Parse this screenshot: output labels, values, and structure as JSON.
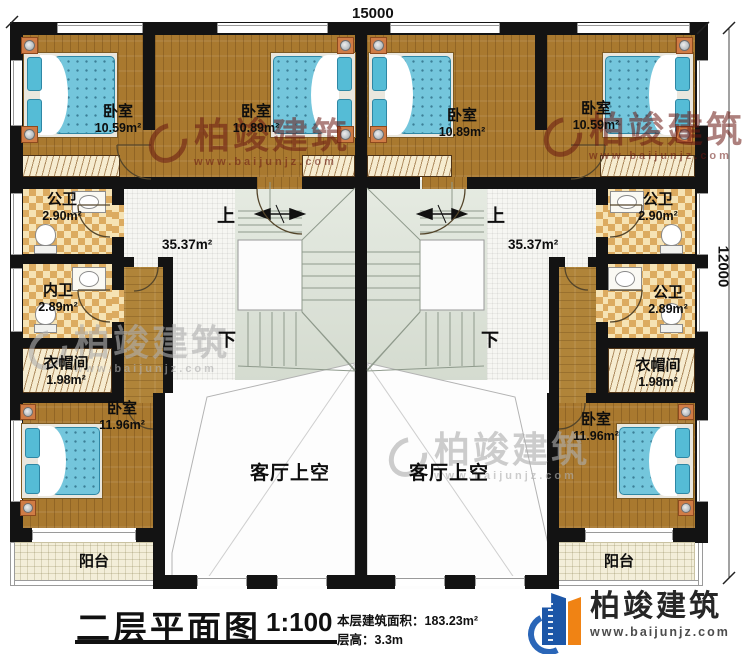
{
  "dimensions": {
    "width_mm": "15000",
    "height_mm": "12000"
  },
  "rooms": {
    "br_tl": {
      "name": "卧室",
      "area": "10.59m²"
    },
    "br_tml": {
      "name": "卧室",
      "area": "10.89m²"
    },
    "br_tmr": {
      "name": "卧室",
      "area": "10.89m²"
    },
    "br_tr": {
      "name": "卧室",
      "area": "10.59m²"
    },
    "bath1_l": {
      "name": "公卫",
      "area": "2.90m²"
    },
    "bath2_l": {
      "name": "内卫",
      "area": "2.89m²"
    },
    "cloak_l": {
      "name": "衣帽间",
      "area": "1.98m²"
    },
    "br_bl": {
      "name": "卧室",
      "area": "11.96m²"
    },
    "balcony_l": {
      "name": "阳台"
    },
    "bath1_r": {
      "name": "公卫",
      "area": "2.90m²"
    },
    "bath2_r": {
      "name": "公卫",
      "area": "2.89m²"
    },
    "cloak_r": {
      "name": "衣帽间",
      "area": "1.98m²"
    },
    "br_br": {
      "name": "卧室",
      "area": "11.96m²"
    },
    "balcony_r": {
      "name": "阳台"
    },
    "hall_l": {
      "area": "35.37m²"
    },
    "hall_r": {
      "area": "35.37m²"
    },
    "void_l": {
      "name": "客厅上空"
    },
    "void_r": {
      "name": "客厅上空"
    }
  },
  "stairs": {
    "up": "上",
    "down": "下"
  },
  "title_block": {
    "title": "二层平面图",
    "scale": "1:100",
    "floor_area_label": "本层建筑面积：",
    "floor_area_value": "183.23m²",
    "floor_height_label": "层高：",
    "floor_height_value": "3.3m"
  },
  "brand": {
    "name": "柏竣建筑",
    "website": "www.baijunjz.com"
  },
  "watermark": {
    "name": "柏竣建筑",
    "website": "www.baijunjz.com"
  }
}
